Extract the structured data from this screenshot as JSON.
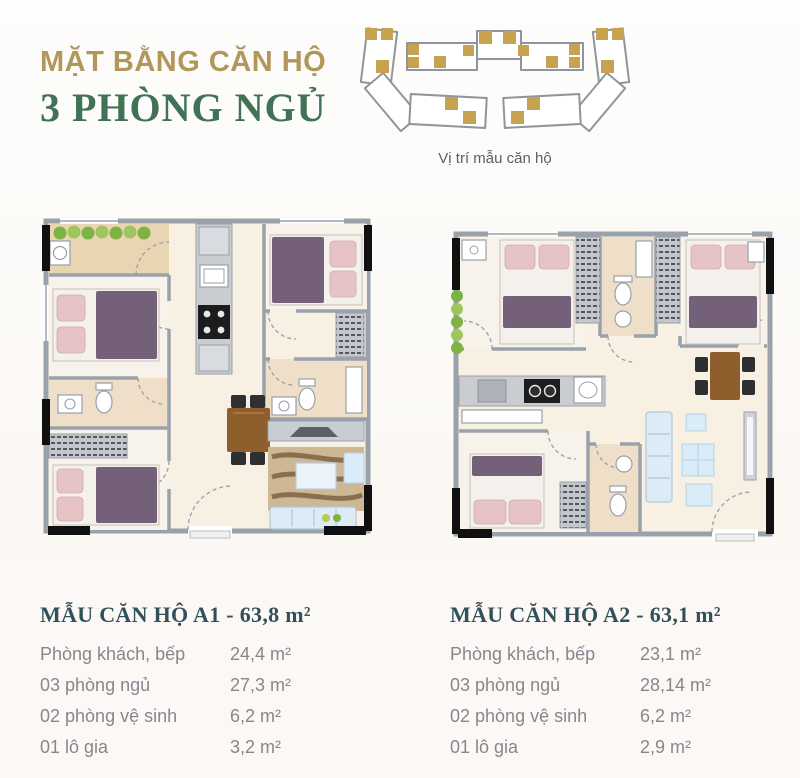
{
  "header": {
    "title_line1": "MẶT BẰNG CĂN HỘ",
    "title_line2": "3 PHÒNG NGỦ"
  },
  "locator": {
    "caption": "Vị trí mẫu căn hộ",
    "marker_meaning": "unit-location-marker"
  },
  "colors": {
    "gold": "#b2975b",
    "green": "#417255",
    "locator_gold": "#c7a24f",
    "outline_gray": "#8f959c",
    "caption": "#5c6065",
    "table_title": "#32505b",
    "table_text": "#84888e",
    "wall": "#99a1ab",
    "floor": "#f8f1e3",
    "bath_floor": "#efdfc8",
    "balcony_floor": "#e9d5b2",
    "blanket": "#746079",
    "pillow": "#e6c4c6",
    "sofa": "#dcebf5",
    "wood": "#8e5e2c",
    "plant": "#7cb342"
  },
  "plans": {
    "a1": {
      "label": "A1"
    },
    "a2": {
      "label": "A2"
    }
  },
  "tables": [
    {
      "title": "MẪU CĂN HỘ A1 - 63,8 m²",
      "rows": [
        {
          "label": "Phòng khách, bếp",
          "value": "24,4 m²"
        },
        {
          "label": "03 phòng ngủ",
          "value": "27,3 m²"
        },
        {
          "label": "02 phòng vệ sinh",
          "value": "6,2 m²"
        },
        {
          "label": "01 lô gia",
          "value": "3,2 m²"
        }
      ]
    },
    {
      "title": "MẪU CĂN HỘ A2 - 63,1 m²",
      "rows": [
        {
          "label": "Phòng khách, bếp",
          "value": "23,1 m²"
        },
        {
          "label": "03 phòng ngủ",
          "value": "28,14 m²"
        },
        {
          "label": "02 phòng vệ sinh",
          "value": "6,2 m²"
        },
        {
          "label": "01 lô gia",
          "value": "2,9 m²"
        }
      ]
    }
  ]
}
